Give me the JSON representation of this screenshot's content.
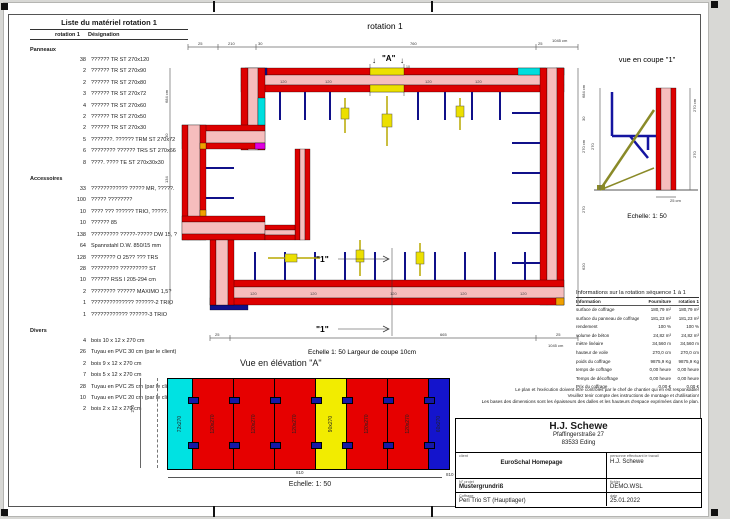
{
  "material_list": {
    "title": "Liste du matériel  rotation 1",
    "col_qty": "rotation 1",
    "col_designation": "Désignation",
    "sections": [
      {
        "name": "Panneaux",
        "items": [
          {
            "qty": "38",
            "label": "?????? TR ST 270x120"
          },
          {
            "qty": "2",
            "label": "?????? TR ST 270x90"
          },
          {
            "qty": "2",
            "label": "?????? TR ST 270x80"
          },
          {
            "qty": "3",
            "label": "?????? TR ST 270x72"
          },
          {
            "qty": "4",
            "label": "?????? TR ST 270x60"
          },
          {
            "qty": "2",
            "label": "?????? TR ST 270x50"
          },
          {
            "qty": "2",
            "label": "?????? TR ST 270x30"
          },
          {
            "qty": "5",
            "label": "???????. ?????? TRM ST 270x72"
          },
          {
            "qty": "6",
            "label": "???????? ?????? TRS ST 270x66"
          },
          {
            "qty": "8",
            "label": "????. ???? TE ST 270x30x30"
          }
        ]
      },
      {
        "name": "Accessoires",
        "items": [
          {
            "qty": "33",
            "label": "???????????? ????? MR, ?????."
          },
          {
            "qty": "100",
            "label": "????? ????????"
          },
          {
            "qty": "10",
            "label": "???? ??? ?????? TRIO, ?????."
          },
          {
            "qty": "10",
            "label": "?????? 85"
          },
          {
            "qty": "138",
            "label": "????????? ?????-????? DW 15, ?"
          },
          {
            "qty": "64",
            "label": "Spannstahl  D.W. 850/15 mm"
          },
          {
            "qty": "128",
            "label": "???????? O 25?? ??? TRS"
          },
          {
            "qty": "28",
            "label": "????????? ????????? ST"
          },
          {
            "qty": "10",
            "label": "?????? RSS I  205-294 cm"
          },
          {
            "qty": "2",
            "label": "???????? ?????? MAXIMO 1,5?"
          },
          {
            "qty": "1",
            "label": "?????????????? ??????-2 TRIO"
          },
          {
            "qty": "1",
            "label": "???????????? ??????-3 TRIO"
          }
        ]
      },
      {
        "name": "Divers",
        "items": [
          {
            "qty": "4",
            "label": "bois 10 x 12 x 270 cm"
          },
          {
            "qty": "26",
            "label": "Tuyau en PVC 30 cm (par le client)"
          },
          {
            "qty": "2",
            "label": "bois 9 x 12 x 270 cm"
          },
          {
            "qty": "7",
            "label": "bois 5 x 12 x 270 cm"
          },
          {
            "qty": "28",
            "label": "Tuyau en PVC 25 cm (par le client)"
          },
          {
            "qty": "10",
            "label": "Tuyau en PVC 20 cm (par le client)"
          },
          {
            "qty": "2",
            "label": "bois 2 x 12 x 270 cm"
          }
        ]
      }
    ]
  },
  "plan": {
    "title": "rotation 1",
    "marker_arrow": "↓",
    "marker_a": "\"A\"",
    "marker_ten": "10",
    "section_marker": "\"1\"",
    "wall_label": "120",
    "scale_note": "Echelle  1: 50   Largeur de coupe 10cm",
    "dims": {
      "t1": "25",
      "t2": "210",
      "t3": "30",
      "t4": "760",
      "t5": "25",
      "t_total": "1045 cm",
      "b1": "25",
      "b2": "665",
      "b3": "25",
      "b_total": "1045 cm",
      "l_total": "684 cm",
      "l1": "30",
      "l2": "134",
      "r_total": "684 cm",
      "r1": "30",
      "r2": "270 cm",
      "r3": "270",
      "r4": "620"
    }
  },
  "coupe": {
    "title": "vue en coupe \"1\"",
    "scale": "Echelle: 1: 50",
    "dim_270": "270",
    "dim_270cm": "270 cm",
    "dim_25": "25 cm"
  },
  "elevation": {
    "title": "Vue en élévation  \"A\"",
    "scale": "Echelle: 1: 50",
    "total": "810",
    "total_cm": "810 cm",
    "height": "270",
    "panels": [
      {
        "label": "72x270",
        "color": "#00e2e2",
        "w": 24,
        "clamp": false
      },
      {
        "label": "120x270",
        "color": "#e60000",
        "w": 40,
        "clamp": true
      },
      {
        "label": "120x270",
        "color": "#e60000",
        "w": 40,
        "clamp": true
      },
      {
        "label": "120x270",
        "color": "#e60000",
        "w": 40,
        "clamp": true
      },
      {
        "label": "90x270",
        "color": "#f2ec00",
        "w": 30,
        "clamp": true
      },
      {
        "label": "120x270",
        "color": "#e60000",
        "w": 40,
        "clamp": true
      },
      {
        "label": "120x270",
        "color": "#e60000",
        "w": 40,
        "clamp": true
      },
      {
        "label": "60x270",
        "color": "#1414cc",
        "w": 20,
        "clamp": true
      }
    ]
  },
  "info_table": {
    "title": "Informations sur la rotation  séquence 1 à 1",
    "col_info": "Information",
    "col_fourniture": "Fourniture",
    "col_rotation": "rotation 1",
    "rows": [
      {
        "label": "surface de coffrage",
        "f": "180,79 m²",
        "r": "180,79 m²"
      },
      {
        "label": "surface du panneau de coffrage",
        "f": "181,23 m²",
        "r": "181,23 m²"
      },
      {
        "label": "rendement",
        "f": "100 %",
        "r": "100 %"
      },
      {
        "label": "volume de béton",
        "f": "24,82 m³",
        "r": "24,82 m³"
      },
      {
        "label": "mètre linéaire",
        "f": "34,560 m",
        "r": "34,560 m"
      },
      {
        "label": "hauteur de voile",
        "f": "270,0 cm",
        "r": "270,0 cm"
      },
      {
        "label": "poids du coffrage",
        "f": "9875,9 Kg",
        "r": "9875,9 Kg"
      },
      {
        "label": "temps de coffrage",
        "f": "0,00 heure",
        "r": "0,00 heure"
      },
      {
        "label": "Temps de décoffrage",
        "f": "0,00 heure",
        "r": "0,00 heure"
      },
      {
        "label": "Prix du coffrage",
        "f": "0,00 €",
        "r": "0,00 €"
      }
    ]
  },
  "notes": {
    "line1": "Le plan et l'exécution doivent être contrôlés par le chef de chantier qui en est responsable!",
    "line2": "Veuillez tenir compte des instructions de montage et d'utilisation!",
    "line3": "Les bases des dimensions sont les épaisseurs des dalles et les hauteurs d'espace exprimées dans le plan."
  },
  "title_block": {
    "company": "H.J. Schewe",
    "street": "Pfaffingerstraße 27",
    "city": "83533 Eding",
    "client_label": "client",
    "client": "EuroSchal Homepage",
    "worker_label": "personne effectuant le travail",
    "worker": "H.J. Schewe",
    "project_label": "N° projet",
    "project": "Mustergrundriß",
    "file_label": "fichier",
    "file": "DEMO.WSL",
    "formwork_label": "Coffrage",
    "formwork": "Peri Trio ST (Hauptlager)",
    "date_label": "date",
    "date": "25.01.2022"
  }
}
